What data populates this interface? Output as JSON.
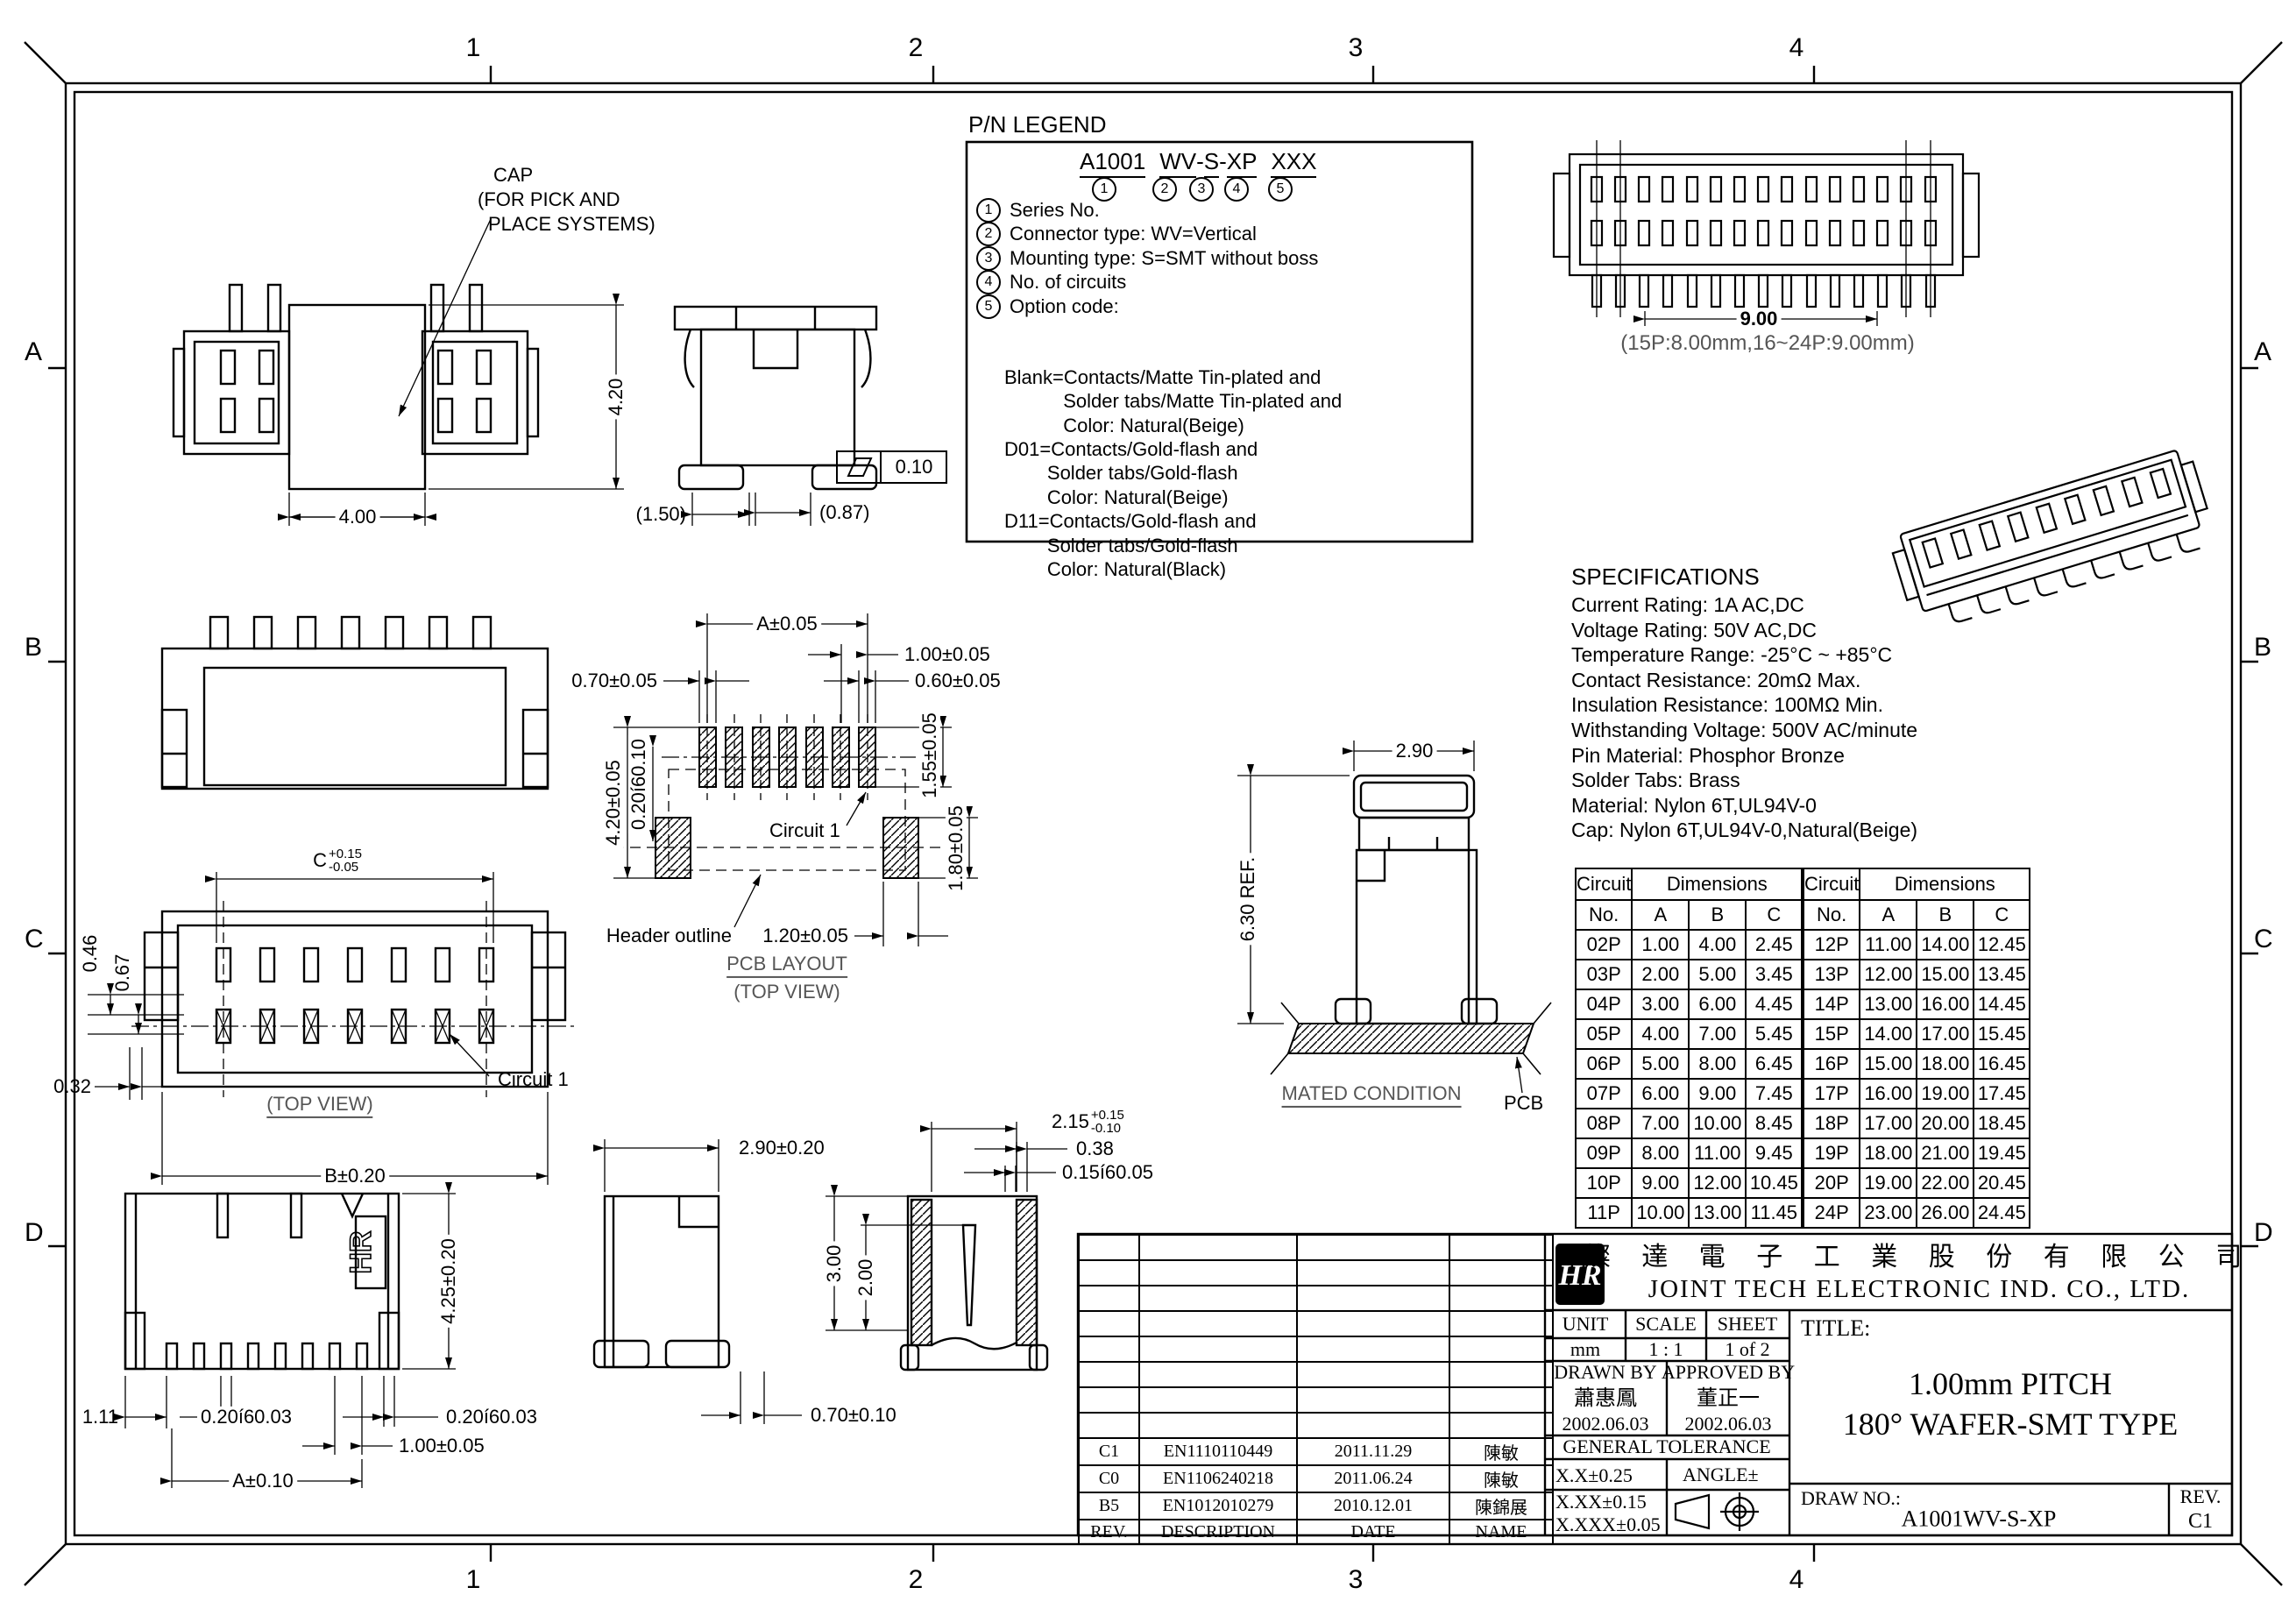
{
  "frame": {
    "zone_numbers": [
      "1",
      "2",
      "3",
      "4"
    ],
    "zone_letters": [
      "A",
      "B",
      "C",
      "D"
    ]
  },
  "pn_legend": {
    "title": "P/N LEGEND",
    "pn_segments": [
      "A1001",
      "WV",
      "S",
      "XP",
      "XXX"
    ],
    "markers": [
      "1",
      "2",
      "3",
      "4",
      "5"
    ],
    "items": [
      {
        "num": "1",
        "text": "Series No."
      },
      {
        "num": "2",
        "text": "Connector type: WV=Vertical"
      },
      {
        "num": "3",
        "text": "Mounting type: S=SMT without boss"
      },
      {
        "num": "4",
        "text": "No. of circuits"
      },
      {
        "num": "5",
        "text": "Option code:"
      }
    ],
    "options": [
      "Blank=Contacts/Matte Tin-plated and",
      "           Solder tabs/Matte Tin-plated and",
      "           Color: Natural(Beige)",
      "D01=Contacts/Gold-flash and",
      "        Solder tabs/Gold-flash",
      "        Color: Natural(Beige)",
      "D11=Contacts/Gold-flash and",
      "        Solder tabs/Gold-flash",
      "        Color: Natural(Black)"
    ]
  },
  "specifications": {
    "title": "SPECIFICATIONS",
    "lines": [
      "Current Rating: 1A AC,DC",
      "Voltage Rating: 50V AC,DC",
      "Temperature Range: -25°C ~ +85°C",
      "Contact Resistance: 20mΩ Max.",
      "Insulation Resistance: 100MΩ Min.",
      "Withstanding Voltage: 500V AC/minute",
      "Pin Material: Phosphor Bronze",
      "Solder Tabs: Brass",
      "Material: Nylon 6T,UL94V-0",
      "Cap: Nylon 6T,UL94V-0,Natural(Beige)"
    ]
  },
  "views": {
    "cap": {
      "callout_l1": "CAP",
      "callout_l2": "(FOR PICK AND",
      "callout_l3": " PLACE SYSTEMS)",
      "dim_width": "4.00",
      "dim_height": "4.20"
    },
    "cap_side": {
      "dim_1": "(1.50)",
      "dim_2": "(0.87)",
      "flatness": "0.10"
    },
    "top_view": {
      "dim_c": "C",
      "dim_c_plus": "+0.15",
      "dim_c_minus": "-0.05",
      "dim_1": "0.46",
      "dim_2": "0.67",
      "dim_3": "0.32",
      "dim_b": "B±0.20",
      "caption": "(TOP VIEW)",
      "circuit": "Circuit 1"
    },
    "front_bottom": {
      "dim_1": "1.11",
      "dim_2": "0.20í60.03",
      "dim_3": "0.20í60.03",
      "dim_4": "1.00±0.05",
      "dim_a": "A±0.10",
      "dim_h": "4.25±0.20",
      "marking": "HR"
    },
    "side_bottom": {
      "dim_w": "2.90±0.20",
      "dim_leg": "0.70±0.10",
      "dim_3": "3.00",
      "dim_2": "2.00",
      "dim_cavity": "2.15",
      "dim_cavity_plus": "+0.15",
      "dim_cavity_minus": "-0.10",
      "dim_wall": "0.38",
      "dim_gap": "0.15í60.05"
    },
    "pcb_layout": {
      "dim_a": "A±0.05",
      "dim_pitch": "1.00±0.05",
      "dim_pad_w": "0.70±0.05",
      "dim_pad_w2": "0.60±0.05",
      "dim_pad_h": "1.55±0.05",
      "dim_v": "4.20±0.05",
      "dim_v2": "0.20í60.10",
      "dim_corner_h": "1.80±0.05",
      "dim_corner_w": "1.20±0.05",
      "circuit": "Circuit 1",
      "header_outline": "Header outline",
      "caption1": "PCB LAYOUT",
      "caption2": "(TOP VIEW)"
    },
    "mated": {
      "dim_w": "2.90",
      "dim_h": "6.30 REF.",
      "caption": "MATED CONDITION",
      "pcb": "PCB"
    },
    "long_top": {
      "dim": "9.00",
      "note": "(15P:8.00mm,16~24P:9.00mm)"
    }
  },
  "dim_table": {
    "header_circuit": "Circuit",
    "header_no": "No.",
    "header_dimensions": "Dimensions",
    "col_a": "A",
    "col_b": "B",
    "col_c": "C",
    "left_rows": [
      [
        "02P",
        "1.00",
        "4.00",
        "2.45"
      ],
      [
        "03P",
        "2.00",
        "5.00",
        "3.45"
      ],
      [
        "04P",
        "3.00",
        "6.00",
        "4.45"
      ],
      [
        "05P",
        "4.00",
        "7.00",
        "5.45"
      ],
      [
        "06P",
        "5.00",
        "8.00",
        "6.45"
      ],
      [
        "07P",
        "6.00",
        "9.00",
        "7.45"
      ],
      [
        "08P",
        "7.00",
        "10.00",
        "8.45"
      ],
      [
        "09P",
        "8.00",
        "11.00",
        "9.45"
      ],
      [
        "10P",
        "9.00",
        "12.00",
        "10.45"
      ],
      [
        "11P",
        "10.00",
        "13.00",
        "11.45"
      ]
    ],
    "right_rows": [
      [
        "12P",
        "11.00",
        "14.00",
        "12.45"
      ],
      [
        "13P",
        "12.00",
        "15.00",
        "13.45"
      ],
      [
        "14P",
        "13.00",
        "16.00",
        "14.45"
      ],
      [
        "15P",
        "14.00",
        "17.00",
        "15.45"
      ],
      [
        "16P",
        "15.00",
        "18.00",
        "16.45"
      ],
      [
        "17P",
        "16.00",
        "19.00",
        "17.45"
      ],
      [
        "18P",
        "17.00",
        "20.00",
        "18.45"
      ],
      [
        "19P",
        "18.00",
        "21.00",
        "19.45"
      ],
      [
        "20P",
        "19.00",
        "22.00",
        "20.45"
      ],
      [
        "24P",
        "23.00",
        "26.00",
        "24.45"
      ]
    ]
  },
  "title_block": {
    "logo_text": "HR",
    "company_cn": "燦 達 電 子 工 業 股 份 有 限 公 司",
    "company_en": "JOINT TECH ELECTRONIC IND. CO., LTD.",
    "unit_label": "UNIT",
    "unit_value": "mm",
    "scale_label": "SCALE",
    "scale_value": "1 : 1",
    "sheet_label": "SHEET",
    "sheet_value": "1 of 2",
    "drawn_label": "DRAWN BY",
    "drawn_name": "蕭惠鳳",
    "drawn_date": "2002.06.03",
    "approved_label": "APPROVED BY",
    "approved_name": "董正一",
    "approved_date": "2002.06.03",
    "tolerance_label": "GENERAL TOLERANCE",
    "tol_1": "X.X±0.25",
    "tol_2": "X.XX±0.15",
    "tol_3": "X.XXX±0.05",
    "angle_label": "ANGLE±",
    "title_label": "TITLE:",
    "title_l1": "1.00mm PITCH",
    "title_l2": "180° WAFER-SMT TYPE",
    "drawno_label": "DRAW NO.:",
    "drawno_value": "A1001WV-S-XP",
    "rev_label": "REV.",
    "rev_value": "C1",
    "revisions": [
      {
        "rev": "C1",
        "desc": "EN1110110449",
        "date": "2011.11.29",
        "name": "陳敏"
      },
      {
        "rev": "C0",
        "desc": "EN1106240218",
        "date": "2011.06.24",
        "name": "陳敏"
      },
      {
        "rev": "B5",
        "desc": "EN1012010279",
        "date": "2010.12.01",
        "name": "陳錦展"
      },
      {
        "rev": "REV.",
        "desc": "DESCRIPTION",
        "date": "DATE",
        "name": "NAME"
      }
    ]
  }
}
